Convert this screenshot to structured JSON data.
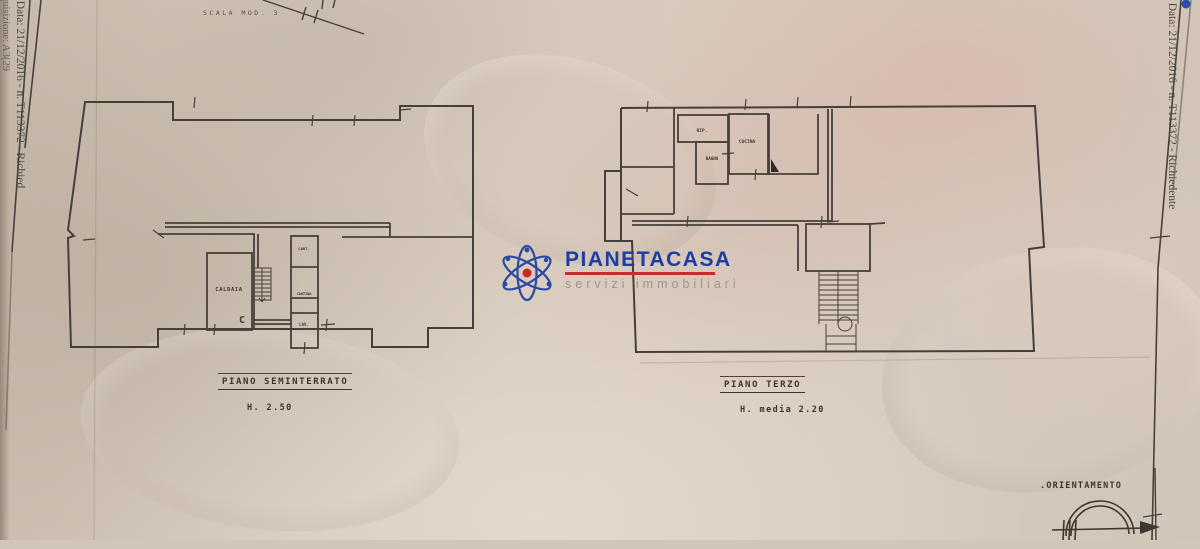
{
  "document": {
    "scale_note": "SCALA MOD. 3",
    "left_edge_line1": "- Data: 21/12/2016 - n. T113372 - Richied",
    "left_edge_line2": "quisizione: A3(29",
    "right_edge_line": "- Data: 21/12/2016 - n. T113372 - Richiedente",
    "paper_color": "#d4c8ba",
    "ink_color": "#3e382f"
  },
  "logo": {
    "name": "PIANETACASA",
    "tagline": "servizi immobiliari",
    "brand_blue": "#1c3da3",
    "brand_red": "#c03028",
    "tagline_gray": "#9b968e"
  },
  "plans": {
    "seminterrato": {
      "title": "PIANO SEMINTERRATO",
      "height_note": "H. 2.50",
      "rooms": {
        "caldaia": "CALDAIA",
        "cant": "CANT.",
        "cantina": "CANTINA",
        "lav": "LAV.",
        "door_mark": "C"
      }
    },
    "terzo": {
      "title": "PIANO TERZO",
      "height_note": "H. media 2.20",
      "rooms": {
        "rip": "RIP.",
        "bagno": "BAGNO",
        "cucina": "CUCINA"
      }
    }
  },
  "orientation": {
    "label": ".ORIENTAMENTO"
  }
}
